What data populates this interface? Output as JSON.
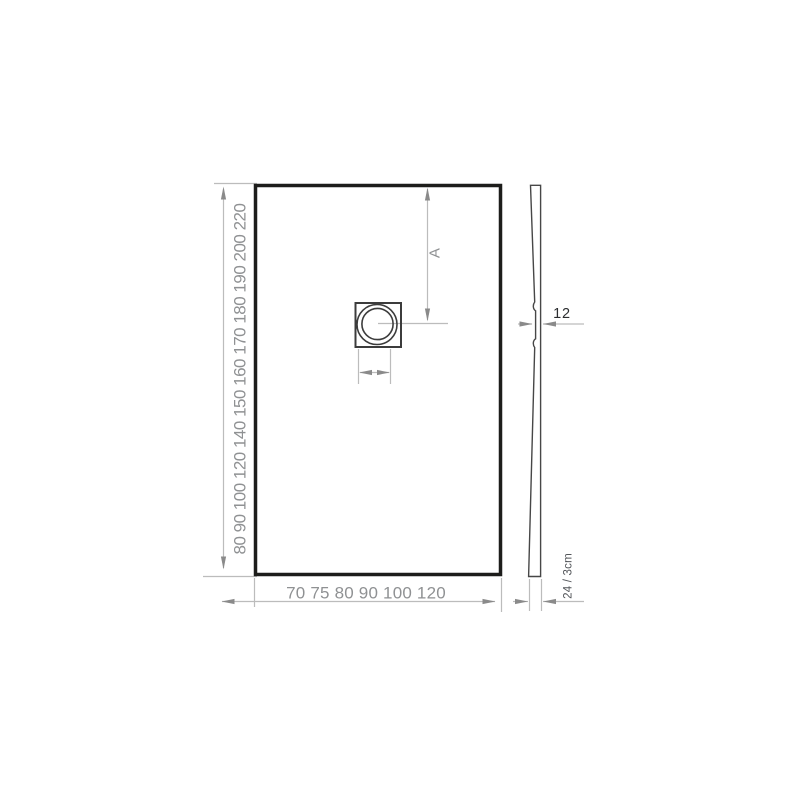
{
  "drawing": {
    "title": "shower-tray-dimension-drawing",
    "front_view": {
      "length_options_cm": [
        80,
        90,
        100,
        120,
        140,
        150,
        160,
        170,
        180,
        190,
        200,
        220
      ],
      "width_options_cm": [
        70,
        75,
        80,
        90,
        100,
        120
      ],
      "drain_distance_label": "A"
    },
    "side_view": {
      "drain_thickness_label": "12",
      "edge_thickness_label": "24 / 3cm"
    },
    "colors": {
      "outline_dark": "#1d1d1b",
      "detail_dark": "#3c3c3c",
      "profile_dark": "#474747",
      "dimension_gray": "#bcbcbc",
      "arrow_gray": "#8a8a8a",
      "label_gray": "#8f9193",
      "label_dark": "#2b2d2f"
    }
  }
}
